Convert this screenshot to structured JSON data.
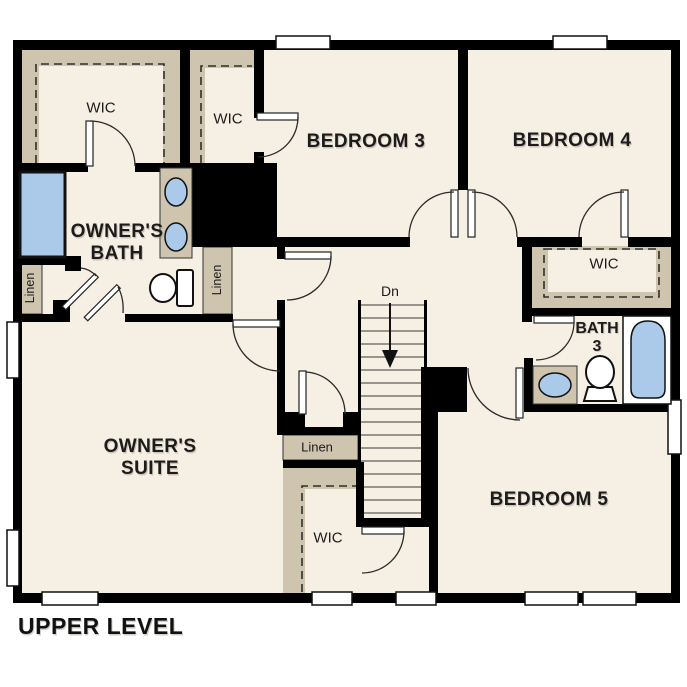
{
  "title": "UPPER LEVEL",
  "colors": {
    "floor": "#f6efe3",
    "closet": "#cfc5af",
    "wall": "#000000",
    "blue": "#abc9e9",
    "ink": "#1c1c1c"
  },
  "rooms": {
    "owners_suite": {
      "line1": "OWNER'S",
      "line2": "SUITE"
    },
    "owners_bath": {
      "line1": "OWNER'S",
      "line2": "BATH"
    },
    "bedroom3": "BEDROOM 3",
    "bedroom4": "BEDROOM 4",
    "bedroom5": "BEDROOM 5",
    "bath3": {
      "line1": "BATH",
      "line2": "3"
    },
    "wic_owner": "WIC",
    "wic_hall": "WIC",
    "wic_bedroom4": "WIC",
    "wic_bedroom5": "WIC",
    "linen_left": "Linen",
    "linen_right": "Linen",
    "linen_center": "Linen",
    "stairs_dn": "Dn"
  }
}
